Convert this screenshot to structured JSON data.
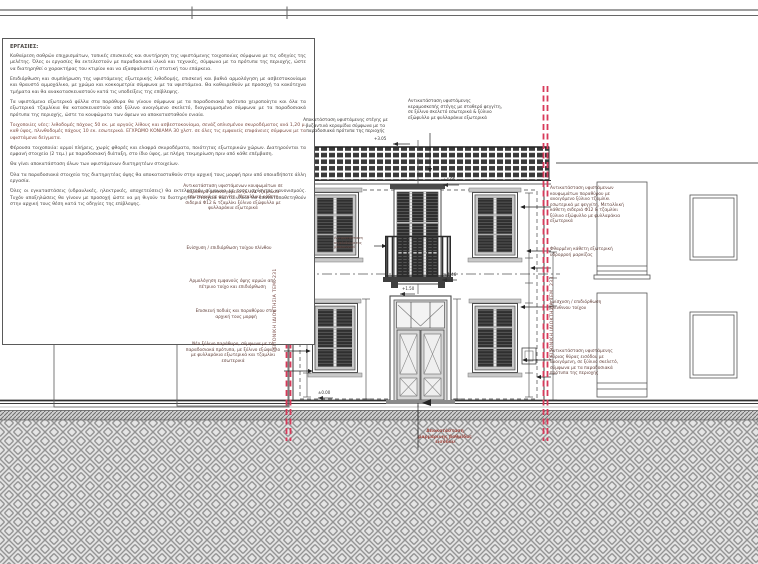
{
  "drawing": {
    "title_block_visible": false,
    "notes": {
      "heading": "ΕΡΓΑΣΙΕΣ:",
      "paragraphs": [
        {
          "cls": "",
          "text": "Καθαίρεση σαθρών επιχρισμάτων, τοπικές επισκευές και συντήρηση της υφιστάμενης τοιχοποιίας σύμφωνα με τις οδηγίες της μελέτης. Όλες οι εργασίες θα εκτελεστούν με παραδοσιακά υλικά και τεχνικές, σύμφωνα με τα πρότυπα της περιοχής, ώστε να διατηρηθεί ο χαρακτήρας του κτιρίου και να εξασφαλιστεί η στατική του επάρκεια."
        },
        {
          "cls": "",
          "text": "Επιδιόρθωση και συμπλήρωση της υφιστάμενης εξωτερικής λιθοδομής, επισκευή και βαθιά αρμολόγηση με ασβεστοκονίαμα και θραυστό αμμοχάλικο, με χρώμα και κοκκομετρία σύμφωνα με τα υφιστάμενα. Θα καθαιρεθούν με προσοχή τα κακότεχνα τμήματα και θα ανακατασκευαστούν κατά τις υποδείξεις της επίβλεψης."
        },
        {
          "cls": "",
          "text": "Τα υφιστάμενα εξωτερικά φύλλα στα παράθυρα θα γίνουν σύμφωνα με τα παραδοσιακά πρότυπα χειροποίητα και όλα τα εξωτερικά τζαμλίκια θα κατασκευαστούν από ξύλινο ανοιγόμενο σκελετό, διαγραμμισμένο σύμφωνα με τα παραδοσιακά πρότυπα της περιοχής, ώστε τα κουφώματα των όψεων να αποκατασταθούν ενιαία."
        },
        {
          "cls": "red",
          "text": "Τοιχοποιίες νέες: λιθοδομές πάχους 50 εκ. με αργούς λίθους και ασβεστοκονίαμα, σενάζ οπλισμένου σκυροδέματος ανά 1,20 μ. καθ ύψος, πλινθοδομές πάχους 10 εκ. εσωτερικά. ΕΓΧΡΩΜΟ ΚΟΝΙΑΜΑ 30 χλστ. σε όλες τις εμφανείς επιφάνειες σύμφωνα με τα υφιστάμενα δείγματα."
        },
        {
          "cls": "",
          "text": "Φέρουσα τοιχοποιία: αρμοί πλήρεις, χωρίς φθορές και ελαφρά σκυροδέματα, ποιότητας εξωτερικών χώρων. Διατηρούνται τα εμφανή στοιχεία (2 τεμ.) με παραδοσιακή διάταξη, στο ίδιο ύψος, με πλήρη τεκμηρίωση πριν από κάθε επέμβαση."
        },
        {
          "cls": "",
          "text": "Θα γίνει αποκατάσταση όλων των υφιστάμενων διατηρητέων στοιχείων."
        },
        {
          "cls": "",
          "text": "Όλα τα παραδοσιακά στοιχεία της διατηρητέας όψης θα αποκατασταθούν στην αρχική τους μορφή πριν από οποιαδήποτε άλλη εργασία."
        },
        {
          "cls": "",
          "text": "Όλες οι εγκαταστάσεις (υδραυλικές, ηλεκτρικές, αποχετεύσεις) θα εκτελεστούν σύμφωνα με τους ισχύοντες κανονισμούς. Τυχόν αποξηλώσεις θα γίνουν με προσοχή ώστε να μη θιγούν τα διατηρητέα στοιχεία και τα υλικά θα επανατοποθετηθούν στην αρχική τους θέση κατά τις οδηγίες της επίβλεψης."
        }
      ]
    },
    "annotations": {
      "roof_left": "Αποκατάσταση υφιστάμενης στέγης με βυζαντινά κεραμίδια σύμφωνα με τα παραδοσιακά πρότυπα της περιοχής",
      "roof_right": "Αντικατάσταση υφιστάμενης κεραμοσκεπής στέγης με σταθερό φεγγίτη, σε ξύλινο σκελετό εσωτερικά & ξύλινο εξώφυλλο με φυλλαράκια εξωτερικά",
      "windows_left": "Αντικατάσταση υφιστάμενων κουφωμάτων σε παράθυρα με ανοιγόμενα ξύλινα τζαμλίκια εσωτερικά με φεγγίτη, Μεταλλική κάθετη σιδεριά Φ12 & τζαμλίκι ξύλινο εξώφυλλο με φυλλαράκια εξωτερικά",
      "wall_brick_left": "Ενίσχυση / επιδιόρθωση τοίχου πλίνθου",
      "pointing_left": "Αρμολόγηση εμφανούς όψης αρμών από πέτρινο τοίχο και επιδιόρθωση",
      "sill_repair_left": "Επισκευή ποδιάς και παραθύρου στην αρχική τους μορφή",
      "new_window_left": "Νέο ξύλινο παράθυρο, σύμφωνα με τα παραδοσιακά πρότυπα, με ξύλινο εξώφυλλο με φυλλαράκια εξωτερικά και τζαμλίκι εσωτερικά",
      "windows_right": "Αντικατάσταση υφιστάμενων κουφωμάτων παραθύρου με ανοιγόμενο ξύλινο τζαμλίκι εσωτερικά με φεγγίτη, Μεταλλική κάθετη σιδεριά Φ12 & τζαμλίκι ξύλινο εξώφυλλο με φυλλαράκια εξωτερικά",
      "gutter_right": "Φθαρμένη κάθετη εξωτερική υδρορροή μαρκίζας",
      "wall_brick_right": "Ενίσχυση / επιδιόρθωση πλίνθινου τοίχου",
      "entrance_door_right": "Αντικατάσταση υφιστάμενης κύριας θύρας εισόδου με ανοιγόμενη, σε ξύλινο σκελετό, σύμφωνα με τα παραδοσιακά πρότυπα της περιοχής",
      "balcony_railing": "Αντικατάσταση κιγκλιδώματος μπαλκονιού",
      "entrance_step": "Αποκατάσταση μαρμάρινης βαθμίδας εισόδου"
    },
    "boundaries": {
      "left": "ΓΕΙΤΟΝΙΚΗ ΙΔΙΟΚΤΗΣΙΑ ΤΕΜ. 231",
      "right": "ΓΕΙΤΟΝΙΚΗ ΙΔΙΟΚΤΗΣΙΑ ΤΕΜ. 233"
    },
    "elevations": {
      "roof_left_mark": "+3.05",
      "roof_right_mark": "+4.05",
      "balcony_mark": "+1.46",
      "door_mark": "+1.50",
      "ground_mark": "±0.00"
    },
    "colors": {
      "boundary_red": "#d83a5a",
      "line_dark": "#3c3c3c",
      "annotation_text": "#63423c",
      "shutter_dark": "#2f2f2f",
      "ground_gray": "#bdbdbd"
    }
  }
}
